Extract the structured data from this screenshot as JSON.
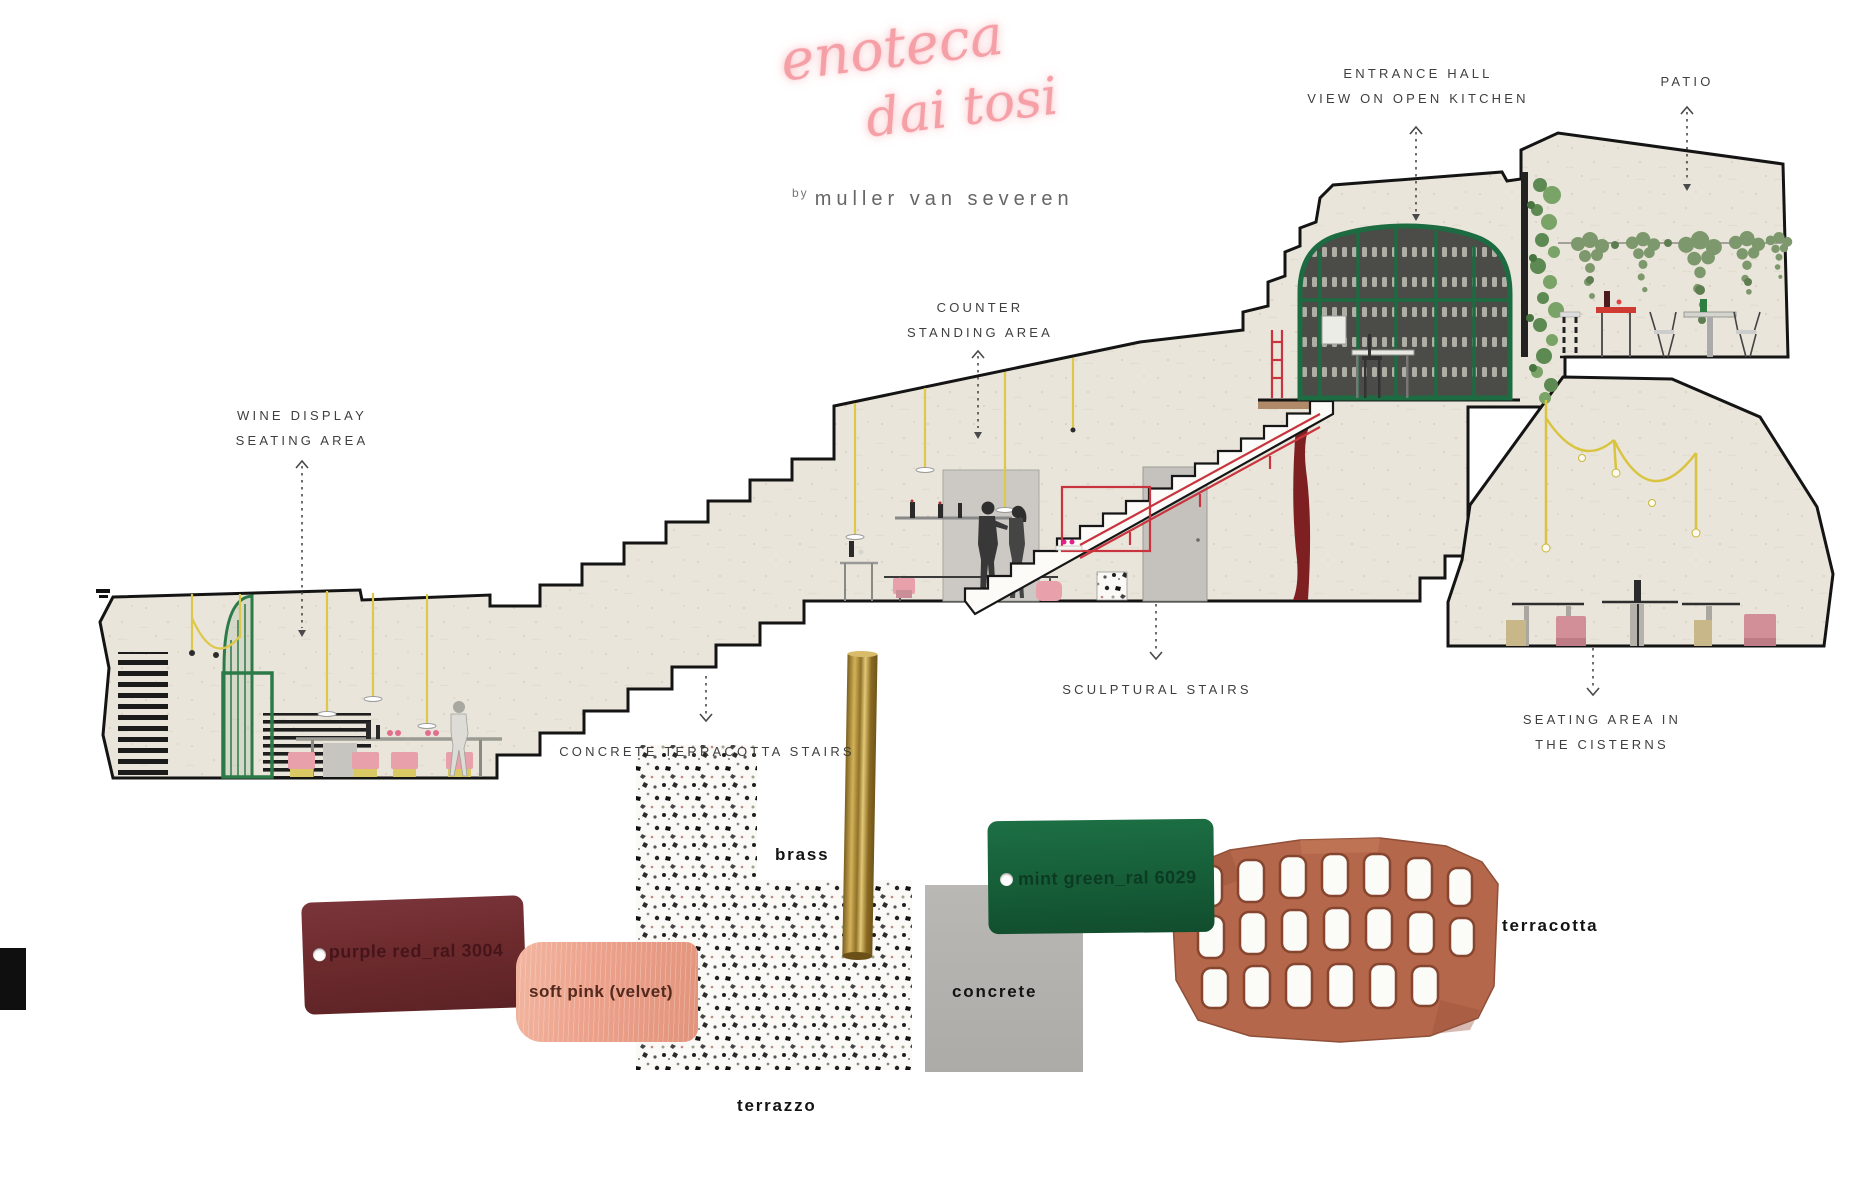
{
  "page": {
    "width": 1872,
    "height": 1200,
    "background": "#ffffff"
  },
  "title": {
    "line1": "enoteca",
    "line2": "dai tosi",
    "byline_prefix": "by",
    "byline": "muller van severen",
    "color": "#f5a0a7"
  },
  "annotations": {
    "wine_display": {
      "line1": "WINE DISPLAY",
      "line2": "SEATING AREA"
    },
    "counter": {
      "line1": "COUNTER",
      "line2": "STANDING AREA"
    },
    "entrance_hall": {
      "line1": "ENTRANCE HALL",
      "line2": "VIEW ON OPEN KITCHEN"
    },
    "patio": {
      "line1": "PATIO"
    },
    "sculptural_stairs": {
      "line1": "SCULPTURAL STAIRS"
    },
    "concrete_terracotta_stairs": {
      "line1": "CONCRETE TERRACOTTA STAIRS"
    },
    "cisterns": {
      "line1": "SEATING AREA IN",
      "line2": "THE CISTERNS"
    }
  },
  "materials": {
    "purple_red": {
      "label": "purple red_ral 3004",
      "color": "#6e2b2e"
    },
    "soft_pink": {
      "label": "soft pink (velvet)",
      "color": "#eda28c"
    },
    "terrazzo": {
      "label": "terrazzo",
      "color": "#faf9f6"
    },
    "brass": {
      "label": "brass",
      "color": "#b3903e"
    },
    "concrete": {
      "label": "concrete",
      "color": "#b5b3af"
    },
    "mint_green": {
      "label": "mint green_ral 6029",
      "color": "#17603a"
    },
    "terracotta": {
      "label": "terracotta",
      "color": "#b4674a"
    }
  },
  "palette": {
    "stone": "#eae5da",
    "outline": "#141414",
    "frame_green": "#1d6b41",
    "railing_red": "#c9353f",
    "cord_yellow": "#ddc84a",
    "stool_pink": "#e8a0aa",
    "curtain_red": "#7e1f22",
    "label_text": "#3f3f3f"
  }
}
